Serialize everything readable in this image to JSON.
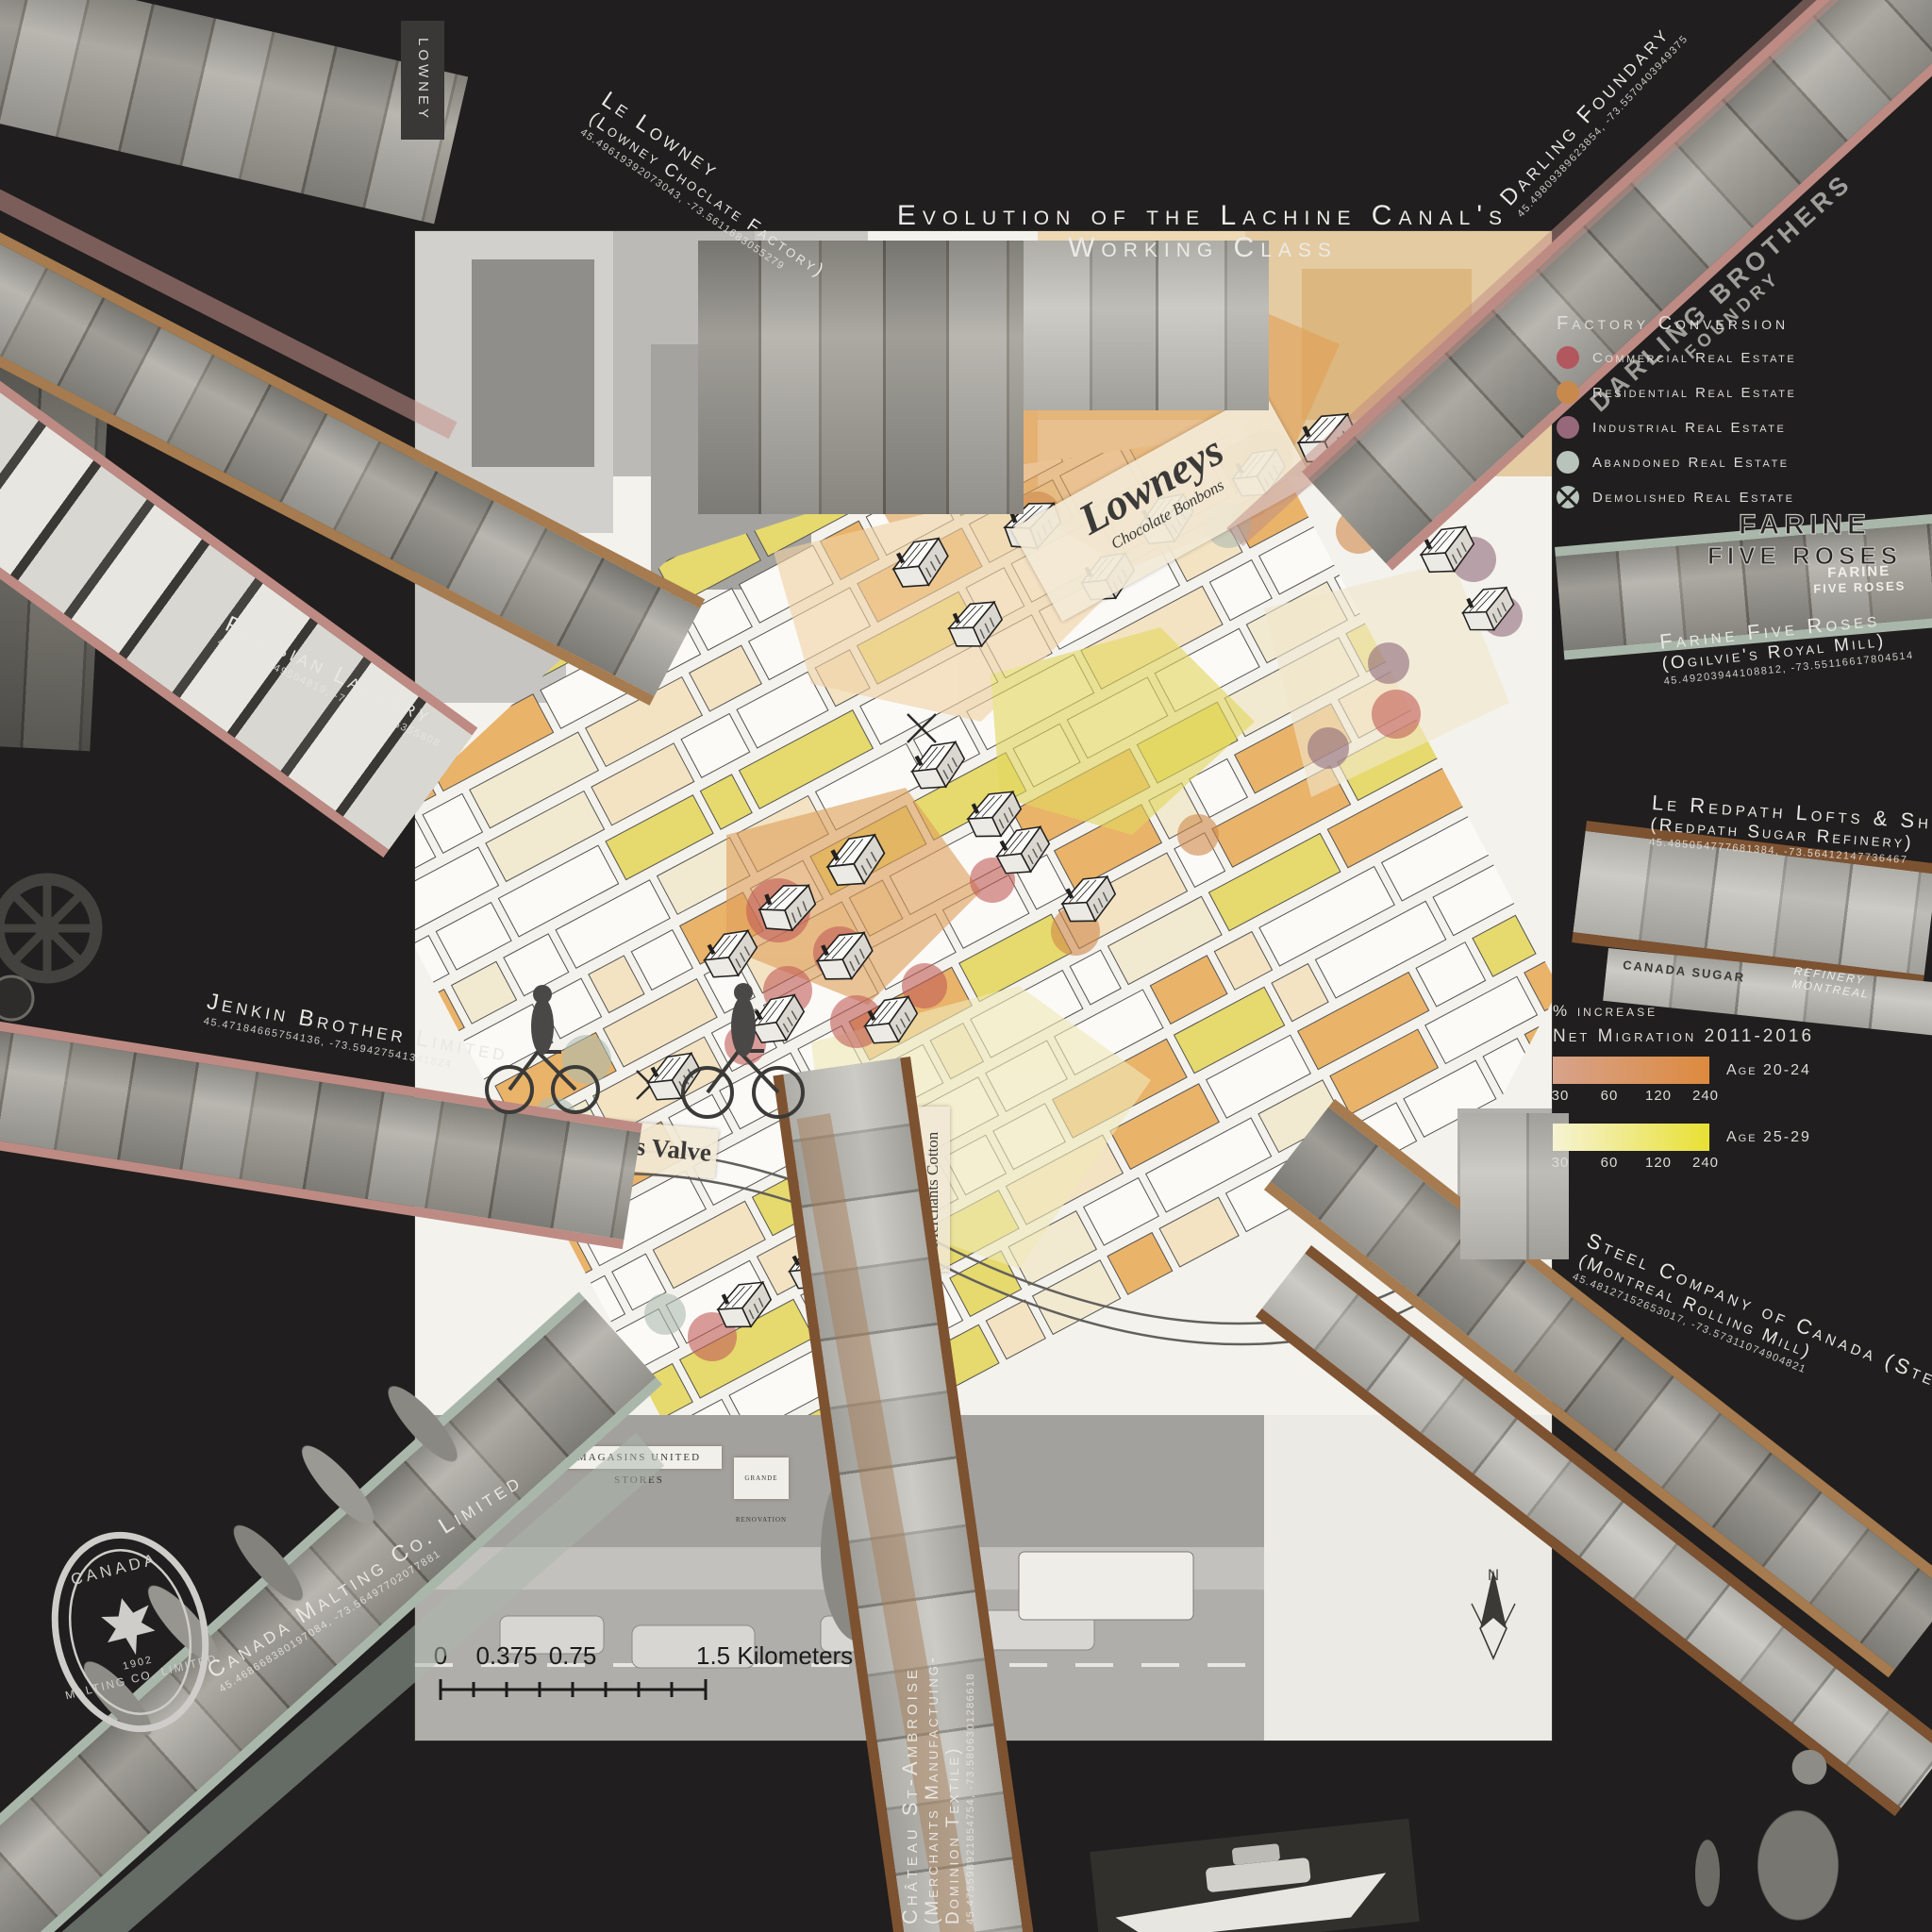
{
  "title": "Evolution of the Lachine Canal's Working Class",
  "colors": {
    "background": "#201e1e",
    "map_panel": "#f4f2ed",
    "accent_tan": "#a57b4f",
    "accent_rose": "#bd8b83",
    "accent_sage": "#a9b7ab",
    "accent_brown": "#7d5231"
  },
  "legend_factory": {
    "title": "Factory Conversion",
    "items": [
      {
        "label": "Commercial Real Estate",
        "color": "#b2575e"
      },
      {
        "label": "Residential Real Estate",
        "color": "#c8894c"
      },
      {
        "label": "Industrial Real Estate",
        "color": "#96687a"
      },
      {
        "label": "Abandoned Real Estate",
        "color": "#b7c3bb"
      },
      {
        "label": "Demolished Real Estate",
        "color": "#b7c3bb",
        "demolished": true
      }
    ]
  },
  "legend_migration": {
    "line1": "% increase",
    "line2": "Net Migration 2011-2016",
    "bars": [
      {
        "label": "Age 20-24",
        "ticks": [
          "30",
          "60",
          "120",
          "240"
        ],
        "color_start": "#d7a38b",
        "color_end": "#dd8a3e"
      },
      {
        "label": "Age 25-29",
        "ticks": [
          "30",
          "60",
          "120",
          "240"
        ],
        "color_start": "#f6f3d4",
        "color_end": "#e8e033"
      }
    ]
  },
  "sites": {
    "lowney": {
      "line1": "Le Lowney",
      "line2": "(Lowney Choclate Factory)",
      "coords": "45.49619392073043, -73.5611683055279"
    },
    "darling": {
      "line1": "Darling Foundary",
      "coords": "45.49809389623854, -73.5570403949375"
    },
    "farine": {
      "line1": "Farine Five Roses",
      "line2": "(Ogilvie's Royal Mill)",
      "coords": "45.49203944108812, -73.55116617804514"
    },
    "redpath": {
      "line1": "Le Redpath Lofts & Shops",
      "line2": "(Redpath Sugar Refinery)",
      "coords": "45.485054777681384, -73.56412147736467"
    },
    "parisian": {
      "line1": "Parisian Laundry",
      "coords": "45.48400549504819, -73.5838715355808"
    },
    "jenkin": {
      "line1": "Jenkin Brother Limited",
      "coords": "45.47184665754136, -73.59427541341824"
    },
    "stelco": {
      "line1": "Steel Company of Canada (Stelco)",
      "line2": "(Montreal Rolling Mill)",
      "coords": "45.48127152653017, -73.57311074904821"
    },
    "malting": {
      "line1": "Canada Malting Co. Limited",
      "coords": "45.468668380197084, -73.56497702077881"
    },
    "chateau": {
      "line1": "Château St-Ambroise",
      "line2": "(Merchants Manufactuing-",
      "line3": "Dominion Textile)",
      "coords": "45.475598921854754, -73.5806301286618"
    }
  },
  "map": {
    "scale": {
      "t0": "0",
      "t1": "0.375",
      "t2": "0.75",
      "t3": "1.5 Kilometers"
    },
    "north": {
      "n": "N",
      "s": "S"
    },
    "signs": {
      "lowney_vert": "LOWNEY",
      "lowneys": "Lowneys",
      "bonbons": "Chocolate Bonbons",
      "jenkins": "Jenkins Valve",
      "merchants": "Merchants Cotton",
      "farine1": "FARINE",
      "farine2": "FIVE ROSES",
      "darling1": "DARLING BROTHERS",
      "darling2": "FOUNDRY",
      "united": "MAGASINS UNITED STORES",
      "renovation": "GRANDE RENOVATION",
      "sugar1": "CANADA SUGAR",
      "sugar2": "REFINERY MONTREAL",
      "logo1": "Canada",
      "logo2": "Malting Co. Limited",
      "logo3": "1902"
    }
  }
}
